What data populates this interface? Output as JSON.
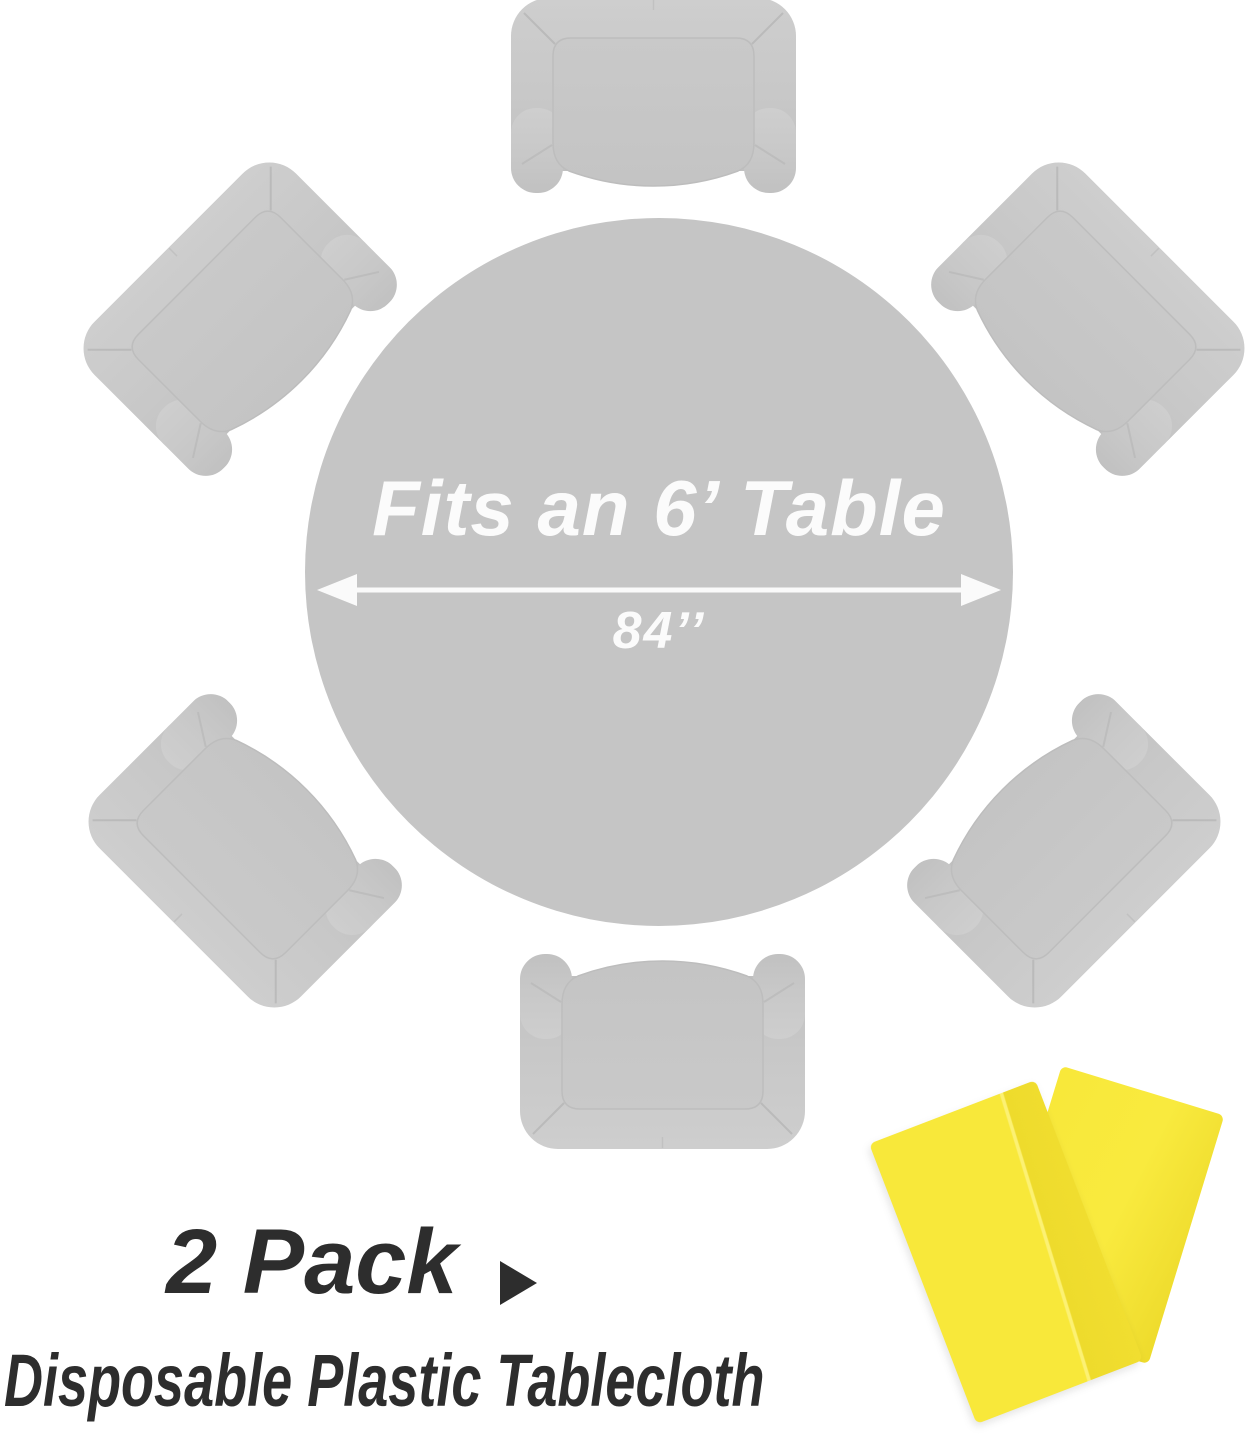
{
  "diagram": {
    "table_label": "Fits an 6’ Table",
    "diameter_label": "84’’",
    "chairs_count": 6,
    "chair_icon": "armchair-top-view-icon",
    "arrow_icon": "double-headed-diameter-arrow-icon"
  },
  "caption": {
    "pack_label": "2 Pack",
    "pointer_icon": "right-pointer-triangle-icon",
    "subtitle": "Disposable Plastic Tablecloth",
    "product_icon": "folded-tablecloths-icon",
    "tablecloth_count": 2
  },
  "colors": {
    "table_gray": "#c5c5c5",
    "chair_gray": "#c8c8c8",
    "arrow_white": "#fbfbfb",
    "text_dark": "#2d2d2d",
    "tablecloth_yellow": "#f8e83a",
    "tablecloth_fold_yellow": "#eedb2c"
  }
}
